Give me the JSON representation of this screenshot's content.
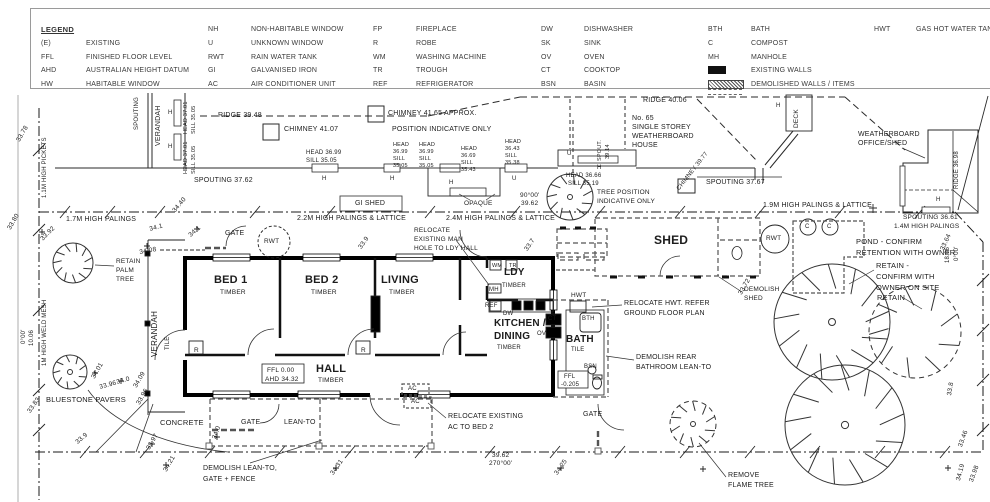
{
  "legend": {
    "title": "LEGEND",
    "columns": [
      [
        {
          "a": "(E)",
          "d": "EXISTING"
        },
        {
          "a": "FFL",
          "d": "FINISHED FLOOR LEVEL"
        },
        {
          "a": "AHD",
          "d": "AUSTRALIAN HEIGHT DATUM"
        },
        {
          "a": "HW",
          "d": "HABITABLE WINDOW"
        }
      ],
      [
        {
          "a": "NH",
          "d": "NON-HABITABLE WINDOW"
        },
        {
          "a": "U",
          "d": "UNKNOWN WINDOW"
        },
        {
          "a": "RWT",
          "d": "RAIN WATER TANK"
        },
        {
          "a": "GI",
          "d": "GALVANISED IRON"
        },
        {
          "a": "AC",
          "d": "AIR CONDITIONER UNIT"
        }
      ],
      [
        {
          "a": "FP",
          "d": "FIREPLACE"
        },
        {
          "a": "R",
          "d": "ROBE"
        },
        {
          "a": "WM",
          "d": "WASHING MACHINE"
        },
        {
          "a": "TR",
          "d": "TROUGH"
        },
        {
          "a": "REF",
          "d": "REFRIGERATOR"
        }
      ],
      [
        {
          "a": "DW",
          "d": "DISHWASHER"
        },
        {
          "a": "SK",
          "d": "SINK"
        },
        {
          "a": "OV",
          "d": "OVEN"
        },
        {
          "a": "CT",
          "d": "COOKTOP"
        },
        {
          "a": "BSN",
          "d": "BASIN"
        }
      ],
      [
        {
          "a": "BTH",
          "d": "BATH"
        },
        {
          "a": "C",
          "d": "COMPOST"
        },
        {
          "a": "MH",
          "d": "MANHOLE"
        },
        {
          "swatch": "existing",
          "d": "EXISTING WALLS"
        },
        {
          "swatch": "demolished",
          "d": "DEMOLISHED WALLS / ITEMS"
        }
      ],
      [
        {
          "a": "HWT",
          "d": "GAS HOT WATER TANK"
        }
      ]
    ]
  },
  "colors": {
    "ink": "#222222",
    "wall": "#000000",
    "demolished": "#555555",
    "background": "#ffffff"
  },
  "labels": [
    {
      "t": "SPOUTING",
      "x": 134,
      "y": 130,
      "r": -90,
      "fs": 6,
      "n": "neighbour-spouting-label"
    },
    {
      "t": "VERANDAH",
      "x": 155,
      "y": 146,
      "r": -90,
      "fs": 7,
      "n": "neighbour-verandah-label"
    },
    {
      "t": "H",
      "x": 168,
      "y": 110,
      "fs": 6
    },
    {
      "t": "H",
      "x": 168,
      "y": 144,
      "fs": 6
    },
    {
      "t": "HEAD 37.01",
      "x": 184,
      "y": 134,
      "r": -90,
      "fs": 5.5
    },
    {
      "t": "SILL 35.05",
      "x": 192,
      "y": 134,
      "r": -90,
      "fs": 5.5
    },
    {
      "t": "HEAD 37.01",
      "x": 184,
      "y": 174,
      "r": -90,
      "fs": 5.5
    },
    {
      "t": "SILL 35.05",
      "x": 192,
      "y": 174,
      "r": -90,
      "fs": 5.5
    },
    {
      "t": "RIDGE 39.48",
      "x": 218,
      "y": 112,
      "fs": 7,
      "n": "ridge-level"
    },
    {
      "t": "CHIMNEY 41.07",
      "x": 284,
      "y": 126,
      "fs": 7,
      "n": "chimney-level"
    },
    {
      "t": "CHIMNEY 41.65 APPROX.",
      "x": 388,
      "y": 110,
      "fs": 7,
      "n": "chimney-level"
    },
    {
      "t": "POSITION INDICATIVE ONLY",
      "x": 392,
      "y": 126,
      "fs": 7
    },
    {
      "t": "SPOUTING 37.62",
      "x": 194,
      "y": 177,
      "fs": 7,
      "n": "spouting-level"
    },
    {
      "t": "HEAD 36.99",
      "x": 306,
      "y": 150,
      "fs": 6
    },
    {
      "t": "SILL 35.05",
      "x": 306,
      "y": 158,
      "fs": 6
    },
    {
      "t": "HEAD",
      "x": 393,
      "y": 143,
      "fs": 5.5
    },
    {
      "t": "36.99",
      "x": 393,
      "y": 150,
      "fs": 5.5
    },
    {
      "t": "SILL",
      "x": 393,
      "y": 157,
      "fs": 5.5
    },
    {
      "t": "35.05",
      "x": 393,
      "y": 164,
      "fs": 5.5
    },
    {
      "t": "HEAD",
      "x": 419,
      "y": 143,
      "fs": 5.5
    },
    {
      "t": "36.99",
      "x": 419,
      "y": 150,
      "fs": 5.5
    },
    {
      "t": "SILL",
      "x": 419,
      "y": 157,
      "fs": 5.5
    },
    {
      "t": "35.05",
      "x": 419,
      "y": 164,
      "fs": 5.5
    },
    {
      "t": "HEAD",
      "x": 461,
      "y": 147,
      "fs": 5.5
    },
    {
      "t": "36.69",
      "x": 461,
      "y": 154,
      "fs": 5.5
    },
    {
      "t": "SILL",
      "x": 461,
      "y": 161,
      "fs": 5.5
    },
    {
      "t": "35.43",
      "x": 461,
      "y": 168,
      "fs": 5.5
    },
    {
      "t": "HEAD",
      "x": 505,
      "y": 140,
      "fs": 5.5
    },
    {
      "t": "36.43",
      "x": 505,
      "y": 147,
      "fs": 5.5
    },
    {
      "t": "SILL",
      "x": 505,
      "y": 154,
      "fs": 5.5
    },
    {
      "t": "35.38",
      "x": 505,
      "y": 161,
      "fs": 5.5
    },
    {
      "t": "H",
      "x": 322,
      "y": 176,
      "fs": 6
    },
    {
      "t": "H",
      "x": 390,
      "y": 176,
      "fs": 6
    },
    {
      "t": "H",
      "x": 449,
      "y": 180,
      "fs": 6
    },
    {
      "t": "U",
      "x": 512,
      "y": 176,
      "fs": 6
    },
    {
      "t": "U",
      "x": 567,
      "y": 151,
      "fs": 6
    },
    {
      "t": "SPOUT.",
      "x": 598,
      "y": 161,
      "r": -90,
      "fs": 5.5
    },
    {
      "t": "39.14",
      "x": 606,
      "y": 159,
      "r": -90,
      "fs": 5.5
    },
    {
      "t": "H",
      "x": 597,
      "y": 165,
      "fs": 6
    },
    {
      "t": "HEAD 36.66",
      "x": 566,
      "y": 173,
      "fs": 6
    },
    {
      "t": "SILL 35.19",
      "x": 568,
      "y": 181,
      "fs": 6
    },
    {
      "t": "RIDGE 40.06",
      "x": 643,
      "y": 97,
      "fs": 7,
      "n": "ridge-level"
    },
    {
      "t": "No. 65",
      "x": 632,
      "y": 115,
      "fs": 7,
      "n": "neighbour-house-label"
    },
    {
      "t": "SINGLE STOREY",
      "x": 632,
      "y": 124,
      "fs": 7
    },
    {
      "t": "WEATHERBOARD",
      "x": 632,
      "y": 133,
      "fs": 7
    },
    {
      "t": "HOUSE",
      "x": 632,
      "y": 142,
      "fs": 7
    },
    {
      "t": "TREE POSITION",
      "x": 597,
      "y": 190,
      "fs": 6.5,
      "n": "note-tree-position"
    },
    {
      "t": "INDICATIVE ONLY",
      "x": 597,
      "y": 199,
      "fs": 6.5
    },
    {
      "t": "CHIMNEY 39.77",
      "x": 676,
      "y": 188,
      "r": -52,
      "fs": 6,
      "n": "chimney-level"
    },
    {
      "t": "SPOUTING 37.67",
      "x": 706,
      "y": 179,
      "fs": 7,
      "n": "spouting-level"
    },
    {
      "t": "H",
      "x": 776,
      "y": 103,
      "fs": 6
    },
    {
      "t": "DECK",
      "x": 794,
      "y": 128,
      "r": -90,
      "fs": 6.5,
      "n": "deck-label"
    },
    {
      "t": "WEATHERBOARD",
      "x": 858,
      "y": 131,
      "fs": 7,
      "n": "office-shed-label"
    },
    {
      "t": "OFFICE/SHED",
      "x": 858,
      "y": 140,
      "fs": 7
    },
    {
      "t": "RIDGE 36.98",
      "x": 954,
      "y": 189,
      "r": -90,
      "fs": 6,
      "n": "ridge-level"
    },
    {
      "t": "H",
      "x": 936,
      "y": 197,
      "fs": 6
    },
    {
      "t": "OPAQUE",
      "x": 464,
      "y": 201,
      "fs": 6.5
    },
    {
      "t": "90°00'",
      "x": 520,
      "y": 193,
      "fs": 6.5,
      "n": "boundary-bearing"
    },
    {
      "t": "39.62",
      "x": 521,
      "y": 201,
      "fs": 6.5,
      "n": "boundary-length"
    },
    {
      "t": "1.7M HIGH PALINGS",
      "x": 66,
      "y": 216,
      "fs": 7,
      "n": "fence-label"
    },
    {
      "t": "2.2M HIGH PALINGS & LATTICE",
      "x": 297,
      "y": 215,
      "fs": 7,
      "n": "fence-label"
    },
    {
      "t": "2.4M HIGH PALINGS & LATTICE",
      "x": 446,
      "y": 215,
      "fs": 7,
      "n": "fence-label"
    },
    {
      "t": "1.9M HIGH PALINGS & LATTICE",
      "x": 763,
      "y": 202,
      "fs": 7,
      "n": "fence-label"
    },
    {
      "t": "SPOUTING 36.61",
      "x": 903,
      "y": 215,
      "fs": 6.5,
      "n": "spouting-level"
    },
    {
      "t": "1.4M HIGH PALINGS",
      "x": 894,
      "y": 224,
      "fs": 6.5,
      "n": "fence-label"
    },
    {
      "t": "1.1M HIGH PICKETS",
      "x": 42,
      "y": 198,
      "r": -90,
      "fs": 6,
      "n": "fence-label"
    },
    {
      "t": "1M HIGH WELD MESH",
      "x": 42,
      "y": 366,
      "r": -90,
      "fs": 6,
      "n": "fence-label"
    },
    {
      "t": "10.06",
      "x": 29,
      "y": 346,
      "r": -90,
      "fs": 6,
      "n": "boundary-length"
    },
    {
      "t": "0°00'",
      "x": 21,
      "y": 344,
      "r": -90,
      "fs": 6,
      "n": "boundary-bearing"
    },
    {
      "t": "18.06",
      "x": 945,
      "y": 263,
      "r": -90,
      "fs": 6,
      "n": "boundary-length"
    },
    {
      "t": "0°00'",
      "x": 954,
      "y": 261,
      "r": -90,
      "fs": 6,
      "n": "boundary-bearing"
    },
    {
      "t": "39.62",
      "x": 492,
      "y": 453,
      "fs": 6.5,
      "n": "boundary-length"
    },
    {
      "t": "270°00'",
      "x": 489,
      "y": 461,
      "fs": 6.5,
      "n": "boundary-bearing"
    },
    {
      "t": "GI SHED",
      "x": 355,
      "y": 200,
      "fs": 7,
      "n": "gi-shed-label"
    },
    {
      "t": "33.78",
      "x": 16,
      "y": 140,
      "r": -60,
      "n": "spot-level"
    },
    {
      "t": "33.80",
      "x": 7,
      "y": 228,
      "r": -60,
      "n": "spot-level"
    },
    {
      "t": "33.92",
      "x": 40,
      "y": 238,
      "r": -45,
      "n": "spot-level"
    },
    {
      "t": "34.40",
      "x": 172,
      "y": 210,
      "r": -50,
      "n": "spot-level"
    },
    {
      "t": "34.1",
      "x": 149,
      "y": 227,
      "r": -15,
      "n": "spot-level"
    },
    {
      "t": "34.1",
      "x": 188,
      "y": 234,
      "r": -40,
      "n": "spot-level"
    },
    {
      "t": "34.08",
      "x": 139,
      "y": 250,
      "r": -10,
      "n": "spot-level"
    },
    {
      "t": "33.9",
      "x": 358,
      "y": 247,
      "r": -55,
      "n": "spot-level"
    },
    {
      "t": "33.7",
      "x": 524,
      "y": 249,
      "r": -55,
      "n": "spot-level"
    },
    {
      "t": "33.72",
      "x": 738,
      "y": 293,
      "r": -60,
      "n": "spot-level"
    },
    {
      "t": "33.64",
      "x": 940,
      "y": 249,
      "r": -65,
      "n": "spot-level"
    },
    {
      "t": "34.01",
      "x": 91,
      "y": 377,
      "r": -60,
      "n": "spot-level"
    },
    {
      "t": "33.96",
      "x": 99,
      "y": 385,
      "r": -15,
      "n": "spot-level"
    },
    {
      "t": "34.0",
      "x": 116,
      "y": 380,
      "r": -15,
      "n": "spot-level"
    },
    {
      "t": "34.09",
      "x": 133,
      "y": 386,
      "r": -60,
      "n": "spot-level"
    },
    {
      "t": "33.96",
      "x": 136,
      "y": 403,
      "r": -60,
      "n": "spot-level"
    },
    {
      "t": "33.83",
      "x": 27,
      "y": 411,
      "r": -55,
      "n": "spot-level"
    },
    {
      "t": "33.9",
      "x": 75,
      "y": 441,
      "r": -40,
      "n": "spot-level"
    },
    {
      "t": "33.97",
      "x": 146,
      "y": 448,
      "r": -60,
      "n": "spot-level"
    },
    {
      "t": "34.21",
      "x": 163,
      "y": 470,
      "r": -60,
      "n": "spot-level"
    },
    {
      "t": "34.0",
      "x": 212,
      "y": 438,
      "r": -70,
      "n": "spot-level"
    },
    {
      "t": "34.31",
      "x": 330,
      "y": 473,
      "r": -55,
      "n": "spot-level"
    },
    {
      "t": "34.25",
      "x": 554,
      "y": 473,
      "r": -55,
      "n": "spot-level"
    },
    {
      "t": "33.8",
      "x": 947,
      "y": 395,
      "r": -80,
      "n": "spot-level"
    },
    {
      "t": "33.46",
      "x": 958,
      "y": 446,
      "r": -70,
      "n": "spot-level"
    },
    {
      "t": "34.19",
      "x": 956,
      "y": 480,
      "r": -75,
      "n": "spot-level"
    },
    {
      "t": "33.98",
      "x": 969,
      "y": 481,
      "r": -70,
      "n": "spot-level"
    },
    {
      "t": "BED 1",
      "x": 214,
      "y": 275,
      "fs": 11,
      "b": 1,
      "n": "room-label-bed1"
    },
    {
      "t": "TIMBER",
      "x": 220,
      "y": 290,
      "fs": 6.5
    },
    {
      "t": "BED 2",
      "x": 305,
      "y": 275,
      "fs": 11,
      "b": 1,
      "n": "room-label-bed2"
    },
    {
      "t": "TIMBER",
      "x": 311,
      "y": 290,
      "fs": 6.5
    },
    {
      "t": "LIVING",
      "x": 381,
      "y": 275,
      "fs": 11,
      "b": 1,
      "n": "room-label-living"
    },
    {
      "t": "TIMBER",
      "x": 389,
      "y": 290,
      "fs": 6.5
    },
    {
      "t": "HALL",
      "x": 316,
      "y": 364,
      "fs": 11,
      "b": 1,
      "n": "room-label-hall"
    },
    {
      "t": "TIMBER",
      "x": 318,
      "y": 378,
      "fs": 6.5
    },
    {
      "t": "LDY",
      "x": 504,
      "y": 268,
      "fs": 10,
      "b": 1,
      "n": "room-label-laundry"
    },
    {
      "t": "TIMBER",
      "x": 502,
      "y": 283,
      "fs": 6
    },
    {
      "t": "KITCHEN /",
      "x": 494,
      "y": 319,
      "fs": 10,
      "b": 1,
      "n": "room-label-kitchen"
    },
    {
      "t": "DINING",
      "x": 494,
      "y": 332,
      "fs": 10,
      "b": 1
    },
    {
      "t": "TIMBER",
      "x": 497,
      "y": 345,
      "fs": 6
    },
    {
      "t": "BATH",
      "x": 566,
      "y": 335,
      "fs": 10,
      "b": 1,
      "n": "room-label-bath"
    },
    {
      "t": "TILE",
      "x": 571,
      "y": 347,
      "fs": 6
    },
    {
      "t": "VERANDAH",
      "x": 151,
      "y": 357,
      "r": -90,
      "fs": 8,
      "n": "room-label-verandah"
    },
    {
      "t": "TILE",
      "x": 165,
      "y": 350,
      "r": -90,
      "fs": 6
    },
    {
      "t": "FFL 0.00",
      "x": 267,
      "y": 368,
      "fs": 6.5,
      "n": "ffl-level"
    },
    {
      "t": "AHD 34.32",
      "x": 265,
      "y": 377,
      "fs": 6.5,
      "n": "ahd-level"
    },
    {
      "t": "FFL",
      "x": 564,
      "y": 374,
      "fs": 6,
      "n": "ffl-level"
    },
    {
      "t": "-0.205",
      "x": 561,
      "y": 382,
      "fs": 6
    },
    {
      "t": "R",
      "x": 194,
      "y": 348,
      "fs": 6.5,
      "n": "robe-marker"
    },
    {
      "t": "R",
      "x": 361,
      "y": 348,
      "fs": 6.5,
      "n": "robe-marker"
    },
    {
      "t": "WM",
      "x": 492,
      "y": 264,
      "fs": 5.5,
      "n": "washing-machine-marker"
    },
    {
      "t": "TR",
      "x": 509,
      "y": 264,
      "fs": 5.5,
      "n": "trough-marker"
    },
    {
      "t": "MH",
      "x": 489,
      "y": 287,
      "fs": 6,
      "n": "manhole-marker"
    },
    {
      "t": "REF",
      "x": 485,
      "y": 303,
      "fs": 6,
      "n": "refrigerator-marker"
    },
    {
      "t": "DW",
      "x": 503,
      "y": 311,
      "fs": 6,
      "n": "dishwasher-marker"
    },
    {
      "t": "CT",
      "x": 548,
      "y": 316,
      "fs": 6,
      "n": "cooktop-marker"
    },
    {
      "t": "OV",
      "x": 537,
      "y": 331,
      "fs": 6,
      "n": "oven-marker"
    },
    {
      "t": "HWT",
      "x": 571,
      "y": 293,
      "fs": 6.5,
      "n": "hwt-marker"
    },
    {
      "t": "BTH",
      "x": 582,
      "y": 316,
      "fs": 6,
      "n": "bath-marker"
    },
    {
      "t": "BSN",
      "x": 584,
      "y": 364,
      "fs": 6,
      "n": "basin-marker"
    },
    {
      "t": "GATE",
      "x": 225,
      "y": 230,
      "fs": 7,
      "n": "gate-label"
    },
    {
      "t": "RWT",
      "x": 264,
      "y": 239,
      "fs": 6.5,
      "n": "rwt-marker"
    },
    {
      "t": "RWT",
      "x": 766,
      "y": 236,
      "fs": 6.5,
      "n": "rwt-marker"
    },
    {
      "t": "RELOCATE",
      "x": 414,
      "y": 228,
      "fs": 6.5,
      "n": "note-relocate-manhole"
    },
    {
      "t": "EXISTING MAN",
      "x": 414,
      "y": 237,
      "fs": 6.5
    },
    {
      "t": "HOLE TO LDY HALL",
      "x": 414,
      "y": 246,
      "fs": 6.5
    },
    {
      "t": "SHED",
      "x": 654,
      "y": 234,
      "fs": 12,
      "b": 1,
      "n": "shed-label"
    },
    {
      "t": "DEMOLISH",
      "x": 744,
      "y": 287,
      "fs": 6.5,
      "n": "note-demolish-shed"
    },
    {
      "t": "SHED",
      "x": 744,
      "y": 296,
      "fs": 6.5
    },
    {
      "t": "C",
      "x": 805,
      "y": 224,
      "fs": 6,
      "n": "compost-marker"
    },
    {
      "t": "C",
      "x": 827,
      "y": 224,
      "fs": 6,
      "n": "compost-marker"
    },
    {
      "t": "POND - CONFIRM",
      "x": 856,
      "y": 238,
      "fs": 7.5,
      "n": "note-pond"
    },
    {
      "t": "RETENTION WITH OWNER",
      "x": 856,
      "y": 249,
      "fs": 7.5
    },
    {
      "t": "RETAIN -",
      "x": 876,
      "y": 262,
      "fs": 7.5,
      "n": "note-retain-tree"
    },
    {
      "t": "CONFIRM WITH",
      "x": 876,
      "y": 273,
      "fs": 7.5
    },
    {
      "t": "OWNER ON SITE",
      "x": 876,
      "y": 284,
      "fs": 7.5
    },
    {
      "t": "RETAIN",
      "x": 877,
      "y": 294,
      "fs": 7.5,
      "n": "note-retain-tree"
    },
    {
      "t": "RELOCATE HWT. REFER",
      "x": 624,
      "y": 300,
      "fs": 7,
      "n": "note-relocate-hwt"
    },
    {
      "t": "GROUND FLOOR PLAN",
      "x": 624,
      "y": 310,
      "fs": 7
    },
    {
      "t": "DEMOLISH REAR",
      "x": 636,
      "y": 354,
      "fs": 7,
      "n": "note-demolish-bathroom"
    },
    {
      "t": "BATHROOM LEAN-TO",
      "x": 636,
      "y": 364,
      "fs": 7
    },
    {
      "t": "RETAIN",
      "x": 116,
      "y": 259,
      "fs": 6.5,
      "n": "note-retain-palm"
    },
    {
      "t": "PALM",
      "x": 116,
      "y": 268,
      "fs": 6.5
    },
    {
      "t": "TREE",
      "x": 116,
      "y": 277,
      "fs": 6.5
    },
    {
      "t": "BLUESTONE PAVERS",
      "x": 46,
      "y": 396,
      "fs": 7.5,
      "n": "surface-label"
    },
    {
      "t": "CONCRETE",
      "x": 160,
      "y": 419,
      "fs": 7.5,
      "n": "surface-label"
    },
    {
      "t": "GATE",
      "x": 241,
      "y": 419,
      "fs": 7,
      "n": "gate-label"
    },
    {
      "t": "LEAN-TO",
      "x": 284,
      "y": 419,
      "fs": 7,
      "n": "lean-to-label"
    },
    {
      "t": "DEMOLISH LEAN-TO,",
      "x": 203,
      "y": 465,
      "fs": 7,
      "n": "note-demolish-lean-to"
    },
    {
      "t": "GATE + FENCE",
      "x": 203,
      "y": 476,
      "fs": 7
    },
    {
      "t": "RELOCATE EXISTING",
      "x": 448,
      "y": 413,
      "fs": 7,
      "n": "note-relocate-ac"
    },
    {
      "t": "AC TO BED 2",
      "x": 448,
      "y": 424,
      "fs": 7
    },
    {
      "t": "AC",
      "x": 408,
      "y": 386,
      "fs": 6,
      "n": "ac-marker"
    },
    {
      "t": "AC",
      "x": 411,
      "y": 399,
      "fs": 6,
      "n": "ac-marker"
    },
    {
      "t": "GATE",
      "x": 583,
      "y": 411,
      "fs": 7,
      "n": "gate-label"
    },
    {
      "t": "REMOVE",
      "x": 728,
      "y": 472,
      "fs": 7,
      "n": "note-remove-flame-tree"
    },
    {
      "t": "FLAME TREE",
      "x": 728,
      "y": 482,
      "fs": 7
    }
  ]
}
